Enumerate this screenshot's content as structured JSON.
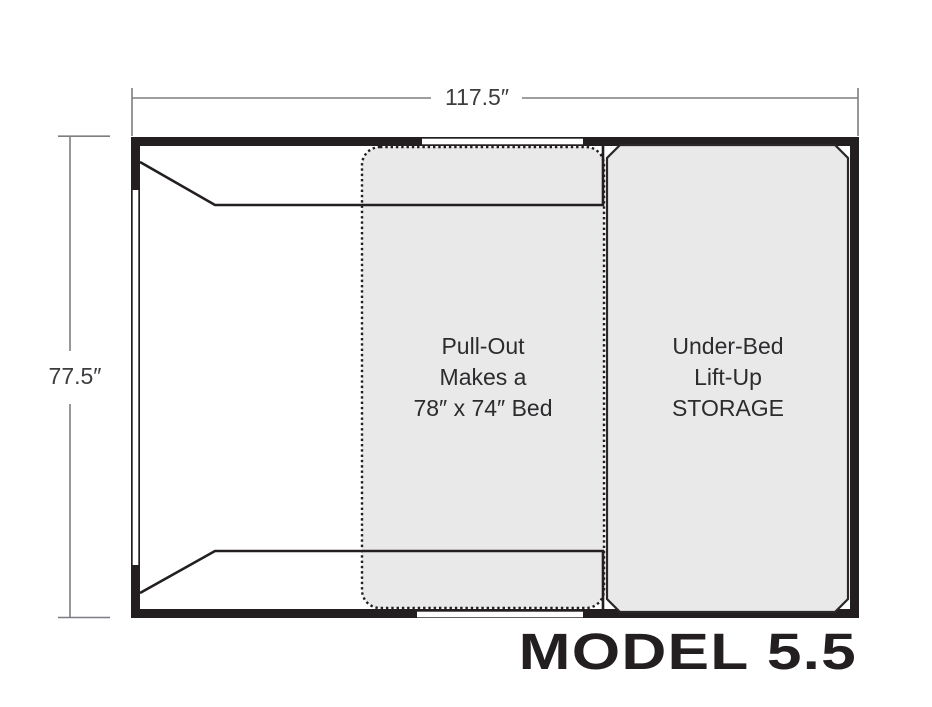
{
  "model_label": "MODEL 5.5",
  "dimensions": {
    "width_label": "117.5″",
    "height_label": "77.5″"
  },
  "pullout": {
    "lines": [
      "Pull-Out",
      "Makes a",
      "78″ x 74″ Bed"
    ]
  },
  "storage": {
    "lines": [
      "Under-Bed",
      "Lift-Up",
      "STORAGE"
    ]
  },
  "colors": {
    "ink": "#231f20",
    "area_fill": "#e9e9ea",
    "dimension_line": "#7d7e81",
    "dimension_text": "#3c3d3f"
  }
}
